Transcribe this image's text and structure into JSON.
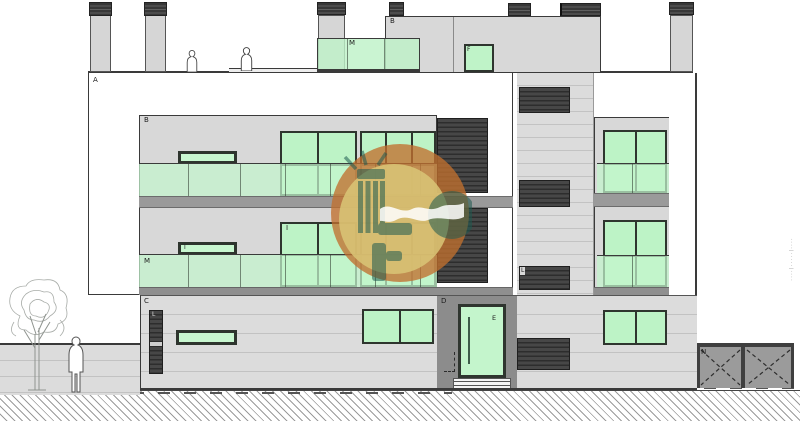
{
  "drawing": {
    "type": "architectural-elevation",
    "labels": {
      "facade_a": "A",
      "penthouse_b": "B",
      "bay_b": "B",
      "roof_m": "M",
      "bay_m": "M",
      "roof_f": "F",
      "window_i_small": "I",
      "window_i_tall": "I",
      "louver_l_bay": "L",
      "louver_l_east": "L",
      "louver_l_ground": "L",
      "ground_c": "C",
      "band_d": "D",
      "door_e": "E",
      "gate_n": "N"
    },
    "side_note": "····|·····|····",
    "colors": {
      "glass_green": "#bdf3c6",
      "balustrade_green": "#c9f6d2",
      "wall_light_gray": "#dcdcdc",
      "slab_gray": "#9a9a9a",
      "louver_dark": "#3f3f3f",
      "logo_orange": "#c06f2e",
      "logo_gold": "#d8c475",
      "logo_teal": "#2c6156"
    }
  }
}
